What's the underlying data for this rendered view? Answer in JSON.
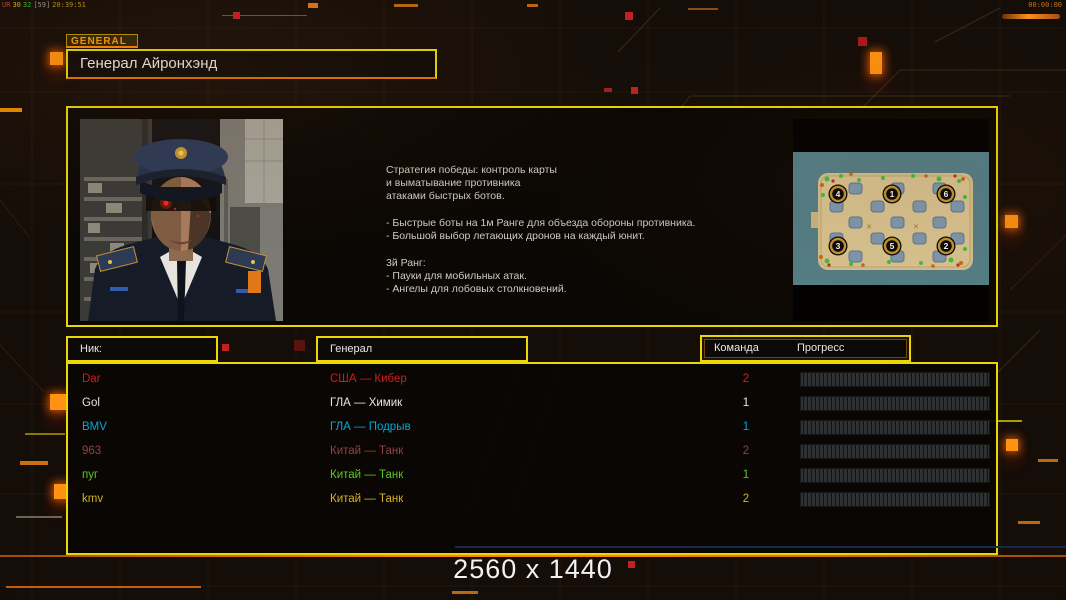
{
  "overlay": {
    "debug": {
      "p1": "UR",
      "p2": "30",
      "p3": "32",
      "p4": "[59]",
      "time": "20:39:51"
    },
    "clock": "00:00:00"
  },
  "header": {
    "tab_label": "GENERAL",
    "title": "Генерал Айронхэнд"
  },
  "strategy": {
    "lines": [
      "Стратегия победы: контроль карты",
      "и выматывание противника",
      "атаками быстрых ботов.",
      "- Быстрые боты на 1м Ранге для объезда обороны противника.",
      "- Большой выбор летающих дронов на каждый юнит.",
      "3й Ранг:",
      "- Пауки для мобильных атак.",
      "- Ангелы для лобовых столкновений."
    ]
  },
  "map": {
    "points": [
      "4",
      "1",
      "6",
      "3",
      "5",
      "2"
    ]
  },
  "table": {
    "headers": {
      "nick": "Ник:",
      "general": "Генерал",
      "team": "Команда",
      "progress": "Прогресс"
    }
  },
  "players": [
    {
      "name": "Dar",
      "general": "США — Кибер",
      "team": "2",
      "color": "#d01c1c",
      "progress_percent": 0
    },
    {
      "name": "Gol",
      "general": "ГЛА — Химик",
      "team": "1",
      "color": "#e6e6e6",
      "progress_percent": 0
    },
    {
      "name": "BMV",
      "general": "ГЛА — Подрыв",
      "team": "1",
      "color": "#00a8d8",
      "progress_percent": 0
    },
    {
      "name": "963",
      "general": "Китай — Танк",
      "team": "2",
      "color": "#8e4440",
      "progress_percent": 0
    },
    {
      "name": "пуг",
      "general": "Китай — Танк",
      "team": "1",
      "color": "#5cc81e",
      "progress_percent": 0
    },
    {
      "name": "kmv",
      "general": "Китай — Танк",
      "team": "2",
      "color": "#d2b222",
      "progress_percent": 0
    }
  ],
  "footer": {
    "resolution": "2560 x 1440"
  },
  "colors": {
    "accent_yellow": "#ecd800",
    "accent_orange": "#ff8a00",
    "debug_red": "#e03030",
    "debug_yellow": "#d8b818",
    "debug_green": "#30c030",
    "debug_gray": "#9a9a9a",
    "background": "#140d08"
  }
}
